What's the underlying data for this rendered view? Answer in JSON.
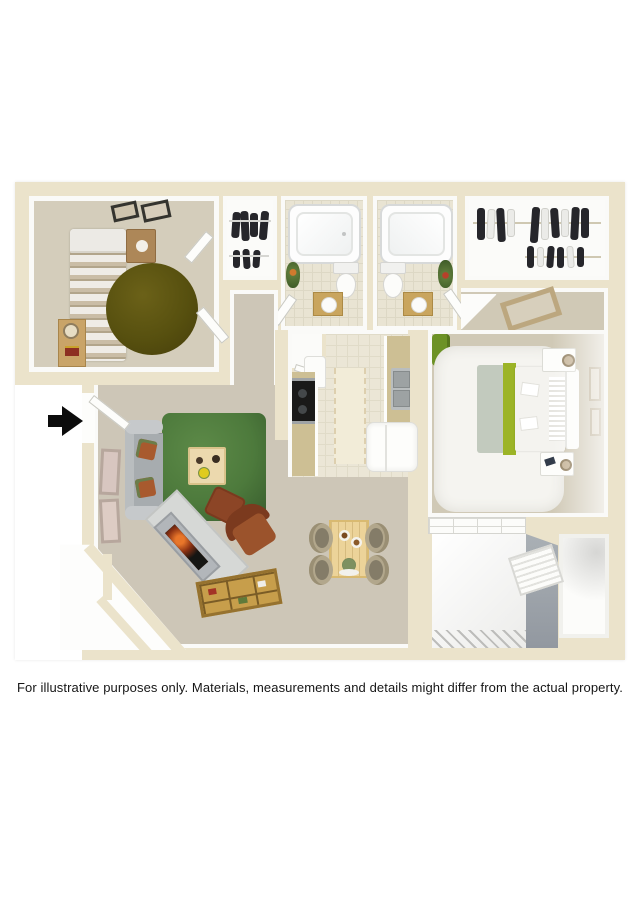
{
  "disclaimer": "For illustrative purposes only.  Materials, measurements and details might differ from the actual property.",
  "floor_plan": {
    "type": "3d-top-down-apartment-floor-plan",
    "entrance_marker": "entry-arrow-right",
    "rooms": [
      "bedroom-2",
      "bedroom-2-closet",
      "bathroom-1",
      "bathroom-2",
      "walk-in-closet",
      "master-bedroom",
      "kitchen",
      "laundry-nook",
      "hallway",
      "living-room",
      "dining-area",
      "patio",
      "storage-closet"
    ]
  },
  "colors": {
    "wall": "#ebe3cb",
    "wall-face": "#fafaf8",
    "carpet": "#cdc6b7",
    "carpet-bedroom": "#d4cdbb",
    "carpet-master": "#d0c9b6",
    "tile": "#ebe6d6",
    "tile-grout": "#e0dbc8",
    "bath-tile": "#e9e4d3",
    "rug-green": "#4d7a3c",
    "rug-olive": "#57500f",
    "sofa-gray": "#a7acaf",
    "rust": "#96522e",
    "wood-light": "#ecd399",
    "wood-media": "#c79e4b",
    "counter-wood": "#cdbf94",
    "accent-green": "#9cb427",
    "gray-wall": "#9da4ab",
    "white-floor": "#fbfbf9",
    "olive-chair": "#6d9226",
    "ink": "#161616"
  }
}
